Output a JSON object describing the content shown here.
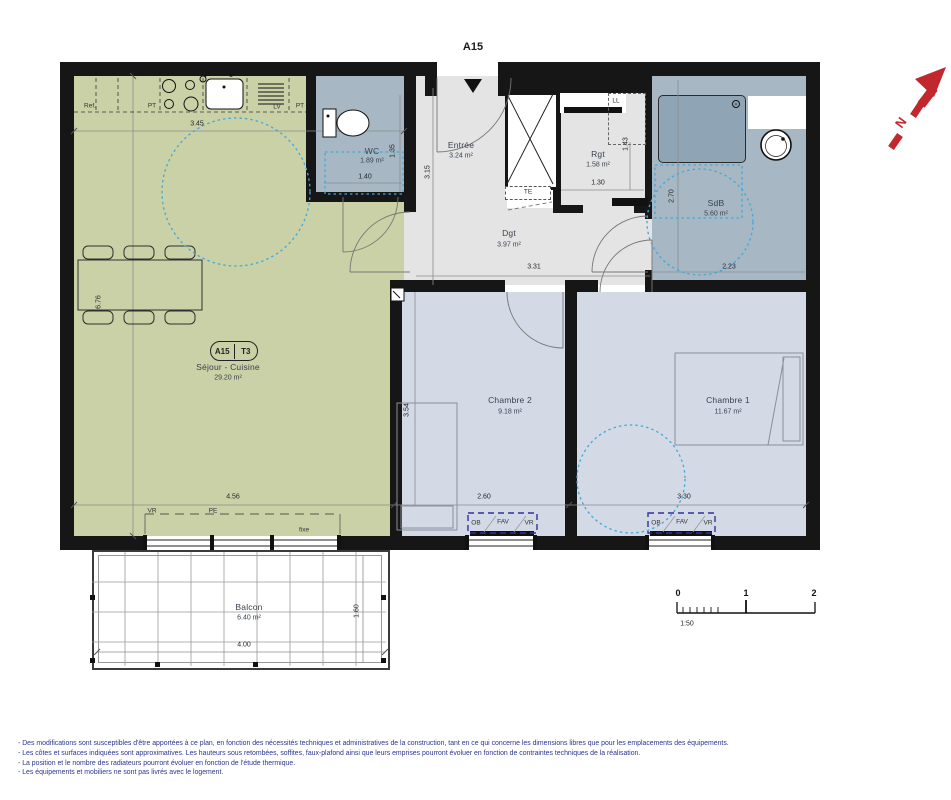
{
  "title_marker": "A15",
  "badge": {
    "unit": "A15",
    "type": "T3"
  },
  "rooms": {
    "sejour": {
      "name": "Séjour - Cuisine",
      "area": "29.20 m²"
    },
    "wc": {
      "name": "WC",
      "area": "1.89 m²"
    },
    "entree": {
      "name": "Entrée",
      "area": "3.24 m²"
    },
    "rgt": {
      "name": "Rgt",
      "area": "1.58 m²"
    },
    "sdb": {
      "name": "SdB",
      "area": "5.60 m²"
    },
    "dgt": {
      "name": "Dgt",
      "area": "3.97 m²"
    },
    "chambre2": {
      "name": "Chambre 2",
      "area": "9.18 m²"
    },
    "chambre1": {
      "name": "Chambre 1",
      "area": "11.67 m²"
    },
    "balcon": {
      "name": "Balcon",
      "area": "6.40 m²"
    }
  },
  "dims": {
    "kitchen_width": "3.45",
    "sejour_height": "6.76",
    "sejour_width": "4.56",
    "wc_height": "1.35",
    "wc_width": "1.40",
    "entree_height": "3.15",
    "rgt_width": "1.30",
    "rgt_height": "1.43",
    "sdb_height": "2.70",
    "sdb_width": "2.23",
    "dgt_width": "3.31",
    "chambre2_height": "3.54",
    "chambre2_width": "2.60",
    "chambre1_width": "3.30",
    "balcon_width": "4.00",
    "balcon_height": "1.60"
  },
  "equipment": {
    "ref": "Ref.",
    "pt_left": "PT",
    "lv": "LV",
    "pt_right": "PT",
    "te": "TE",
    "ll": "LL",
    "vr": "VR",
    "pe": "PE",
    "fixe": "fixe",
    "window_ch2": {
      "ob": "OB",
      "fav": "FAV",
      "vr": "VR"
    },
    "window_ch1": {
      "ob": "OB",
      "fav": "FAV",
      "vr": "VR"
    }
  },
  "scale_bar": {
    "tick0": "0",
    "tick1": "1",
    "tick2": "2",
    "ratio": "1:50"
  },
  "north_label": "N",
  "notes": [
    "- Des modifications sont susceptibles d'être apportées à ce plan, en fonction des nécessités techniques et administratives de la construction, tant en ce qui concerne les dimensions libres que pour les emplacements des équipements.",
    "- Les côtes et surfaces indiquées sont approximatives. Les hauteurs sous retombées, soffites, faux-plafond ainsi que leurs emprises pourront évoluer en fonction de contraintes techniques de la réalisation.",
    "- La position et le nombre des radiateurs pourront évoluer en fonction de l'étude thermique.",
    "- Les équipements et mobiliers ne sont pas livrés avec le logement."
  ],
  "colors": {
    "sejour": "#cbd1a7",
    "bedroom": "#d3dae6",
    "wet_room": "#a7b8c4",
    "hall": "#e4e4e4",
    "shower": "#8fa5b6",
    "wall": "#161616",
    "accessibility_circle": "#3fa9dc",
    "window_marker": "#31319b",
    "north_arrow": "#c1272d",
    "notes_text": "#2b3590"
  }
}
